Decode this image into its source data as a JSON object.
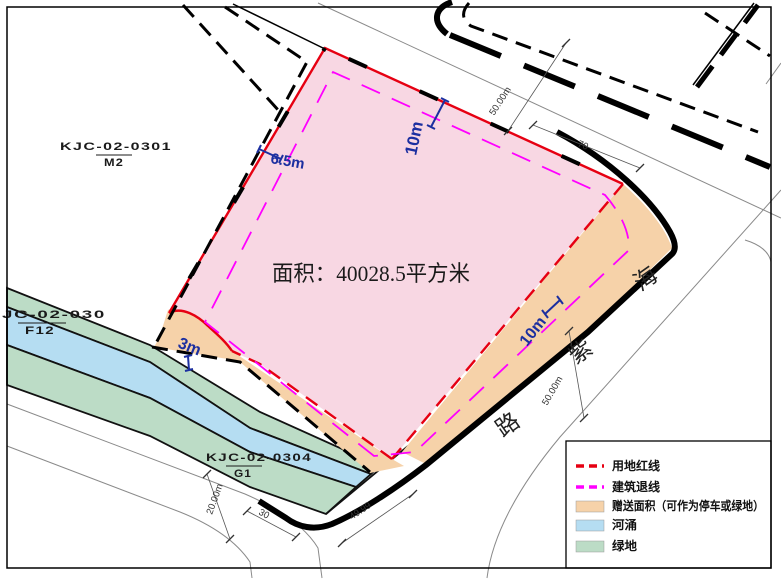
{
  "drawing": {
    "type": "site-plan",
    "main_parcel": {
      "area_label": "面积：40028.5平方米"
    },
    "parcels": [
      {
        "code": "KJC-02-0301",
        "zone": "M2"
      },
      {
        "code": "JC-02-030",
        "zone": "F12"
      },
      {
        "code": "KJC-02-0304",
        "zone": "G1"
      }
    ],
    "road": {
      "name": "海紫路",
      "chars": [
        "海",
        "紫",
        "路"
      ]
    },
    "dimensions": {
      "road_width_top": "50.00m",
      "frontage_top": "70",
      "road_width_right": "50.00m",
      "frontage_bottom": "49.99",
      "frontage_corner": "30",
      "road_width_bottom": "20.00m"
    },
    "setbacks": {
      "top": "10m",
      "left": "6.5m",
      "bottom_left": "3m",
      "right": "10m"
    },
    "legend": {
      "items": [
        {
          "label": "用地红线",
          "style": "dashed",
          "color": "#e60012"
        },
        {
          "label": "建筑退线",
          "style": "dashed",
          "color": "#ff00ff"
        },
        {
          "label": "赠送面积（可作为停车或绿地）",
          "style": "fill",
          "color": "#f6d2a9"
        },
        {
          "label": "河涌",
          "style": "fill",
          "color": "#b5ddf2"
        },
        {
          "label": "绿地",
          "style": "fill",
          "color": "#bcdcc6"
        }
      ]
    },
    "colors": {
      "parcel_pink": "#f8d7e3",
      "boundary_red": "#e60012",
      "setback_magenta": "#ff00ff",
      "gift_orange": "#f6d2a9",
      "river_blue": "#b5ddf2",
      "green_space": "#bcdcc6",
      "annotation_blue": "#1c2fa0",
      "road_casing": "#000000"
    }
  }
}
